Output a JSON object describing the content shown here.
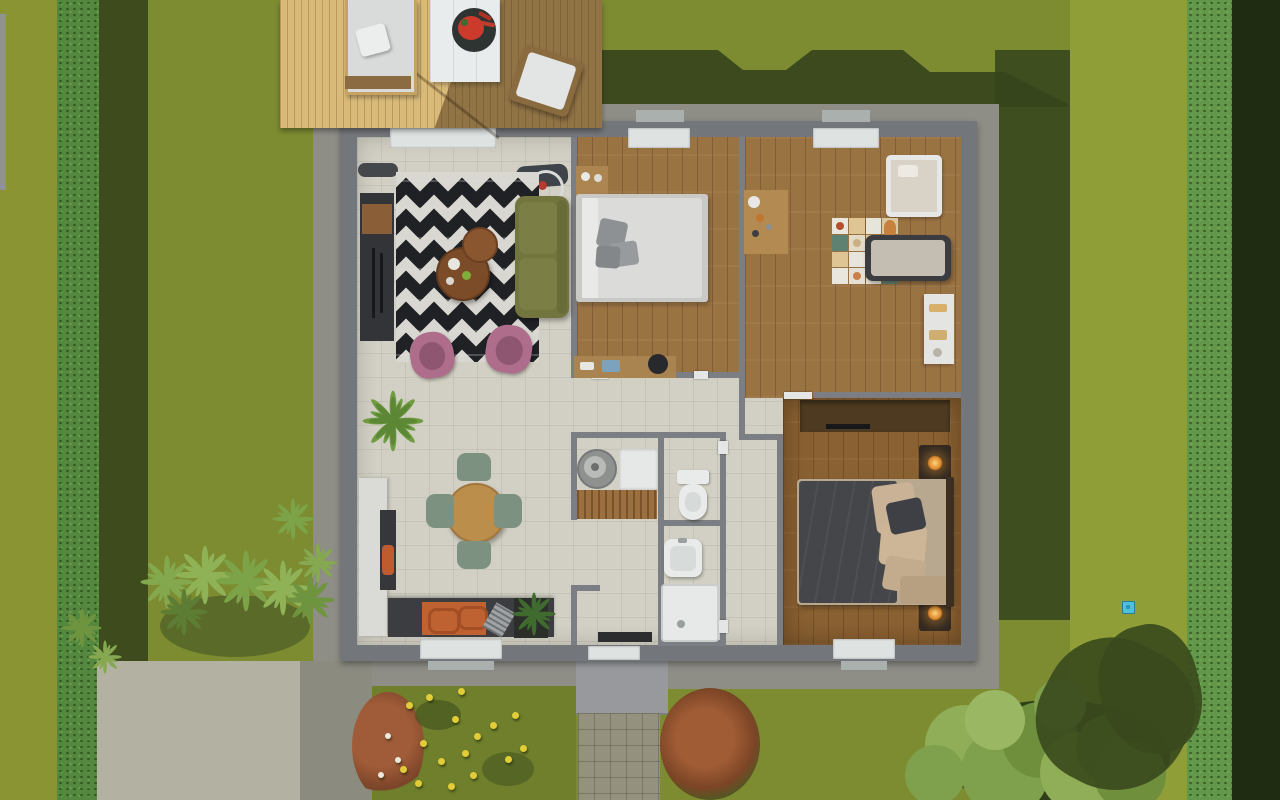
{
  "meta": {
    "description": "Top-down orthographic 3D render of a single-storey house floor plan with furnished rooms, wooden terrace and landscaped garden",
    "view": "top-down",
    "width_px": 1280,
    "height_px": 800
  },
  "palette": {
    "lawn": "#7d8c31",
    "lawn_bright": "#8f9e37",
    "lawn_moss": "#8a9433",
    "hedge": "#55883f",
    "hedge_dark": "#1f2c12",
    "cast_shadow": "#36441c",
    "gravel": "#8e8d86",
    "wall_outer": "#73767a",
    "wall_inner": "#7b7e82",
    "tile_floor": "#d2d0c4",
    "wood_floor": "#9a7343",
    "wood_floor_master": "#8a6132",
    "deck_wood": "#d9ba79",
    "concrete_driveway": "#b2b1a2",
    "paving_path": "#94927f",
    "rug_base": "#d8d7d1",
    "rug_zigzag": "#1f2125",
    "sofa_olive": "#72763e",
    "armchair_pink": "#ad6d8b",
    "coffee_table_wood": "#7c4b28",
    "dining_table_wood": "#bb8e4c",
    "chair_sage": "#7d9181",
    "counter_dark": "#3b3d40",
    "counter_orange": "#bf6231",
    "bed_white": "#dbdbd9",
    "master_duvet": "#44464a",
    "pillow_beige": "#c9b295",
    "mat_teal": "#5f8171",
    "mat_beige": "#dfc593",
    "sanitary_white": "#e9ebea",
    "lamp_glow": "#f2a93b",
    "watermelon_red": "#cc3a2c",
    "flower_yellow": "#e2cd39",
    "flower_white": "#eceadf",
    "marker_cyan": "#4fc0dd"
  },
  "rooms": [
    {
      "name": "living-room",
      "floor": "tile"
    },
    {
      "name": "kitchen-dining",
      "floor": "tile"
    },
    {
      "name": "bedroom-1",
      "floor": "wood"
    },
    {
      "name": "kids-room",
      "floor": "wood"
    },
    {
      "name": "master-bedroom",
      "floor": "wood"
    },
    {
      "name": "wc",
      "floor": "tile"
    },
    {
      "name": "bathroom",
      "floor": "tile"
    },
    {
      "name": "hallway",
      "floor": "tile"
    },
    {
      "name": "laundry-nook",
      "floor": "tile"
    },
    {
      "name": "terrace-deck",
      "floor": "wood-deck"
    }
  ],
  "furniture": [
    "zigzag-rug",
    "olive-sofa",
    "coffee-table-large",
    "coffee-table-small",
    "pink-armchair",
    "pink-armchair",
    "tv-cabinet",
    "floor-lamp",
    "double-bed-white",
    "nightstand",
    "desk",
    "kids-desk",
    "baby-crib",
    "play-mat",
    "toddler-bed",
    "kids-shelf",
    "master-bed",
    "master-sideboard",
    "nightstand-lamp",
    "nightstand-lamp",
    "dining-table",
    "dining-chair",
    "dining-chair",
    "dining-chair",
    "dining-chair",
    "kitchen-counter",
    "kitchen-island",
    "washing-machine",
    "laundry-cabinet",
    "wood-bench",
    "toilet",
    "washbasin",
    "shower-tray",
    "potted-palm",
    "planter-plant",
    "sun-lounger",
    "outdoor-table",
    "watermelon-plate",
    "outdoor-armchair"
  ],
  "garden": {
    "marker": {
      "name": "map-marker",
      "x": 1122,
      "y": 601,
      "color": "#4fc0dd"
    },
    "yellow_flowers": [
      {
        "x": 406,
        "y": 702
      },
      {
        "x": 426,
        "y": 694
      },
      {
        "x": 452,
        "y": 716
      },
      {
        "x": 474,
        "y": 733
      },
      {
        "x": 490,
        "y": 722
      },
      {
        "x": 462,
        "y": 750
      },
      {
        "x": 438,
        "y": 758
      },
      {
        "x": 420,
        "y": 740
      },
      {
        "x": 400,
        "y": 766
      },
      {
        "x": 448,
        "y": 783
      },
      {
        "x": 470,
        "y": 772
      },
      {
        "x": 512,
        "y": 712
      },
      {
        "x": 520,
        "y": 745
      },
      {
        "x": 415,
        "y": 780
      },
      {
        "x": 505,
        "y": 756
      },
      {
        "x": 458,
        "y": 688
      }
    ],
    "white_flowers": [
      {
        "x": 385,
        "y": 733
      },
      {
        "x": 395,
        "y": 757
      },
      {
        "x": 378,
        "y": 772
      }
    ],
    "ferns": [
      {
        "x": 140,
        "y": 555,
        "s": 54,
        "c": "#84a84e"
      },
      {
        "x": 175,
        "y": 545,
        "s": 60,
        "c": "#8fb257"
      },
      {
        "x": 215,
        "y": 550,
        "s": 62,
        "c": "#7da348"
      },
      {
        "x": 255,
        "y": 560,
        "s": 56,
        "c": "#8fb257"
      },
      {
        "x": 285,
        "y": 575,
        "s": 50,
        "c": "#6f9440"
      },
      {
        "x": 160,
        "y": 588,
        "s": 48,
        "c": "#5d7d35"
      },
      {
        "x": 298,
        "y": 543,
        "s": 40,
        "c": "#86a850"
      },
      {
        "x": 272,
        "y": 498,
        "s": 42,
        "c": "#7da348"
      },
      {
        "x": 62,
        "y": 608,
        "s": 40,
        "c": "#6f9440"
      },
      {
        "x": 88,
        "y": 640,
        "s": 34,
        "c": "#86a850"
      }
    ],
    "tree_circles": [
      {
        "x": 965,
        "y": 745,
        "r": 40,
        "c": "#8fae57"
      },
      {
        "x": 1005,
        "y": 772,
        "r": 44,
        "c": "#7fa04c"
      },
      {
        "x": 1040,
        "y": 740,
        "r": 38,
        "c": "#6f8f3d"
      },
      {
        "x": 1080,
        "y": 772,
        "r": 40,
        "c": "#8fae57"
      },
      {
        "x": 1110,
        "y": 748,
        "r": 34,
        "c": "#5d7a33"
      },
      {
        "x": 995,
        "y": 720,
        "r": 30,
        "c": "#9ab763"
      },
      {
        "x": 1060,
        "y": 705,
        "r": 26,
        "c": "#7fa04c"
      },
      {
        "x": 1130,
        "y": 775,
        "r": 36,
        "c": "#6f8f3d"
      },
      {
        "x": 935,
        "y": 775,
        "r": 30,
        "c": "#7fa04c"
      }
    ]
  },
  "kids_room": {
    "mat_colors": [
      "#e9e6de",
      "#dfc593",
      "#e7e4db",
      "#d8c7a0",
      "#5f8171",
      "#e3dac7",
      "#dfc593",
      "#cfd6cb",
      "#dfc593",
      "#e7e4db",
      "#b9b4a9",
      "#5f8171",
      "#e9e6de",
      "#e4e0d5",
      "#e7e4db",
      "#5f8171"
    ],
    "mat_icons": [
      {
        "cell": 0,
        "c": "#b5502e"
      },
      {
        "cell": 5,
        "c": "#c9b184"
      },
      {
        "cell": 13,
        "c": "#c97f46"
      },
      {
        "cell": 14,
        "c": "#3a3d41"
      }
    ]
  }
}
